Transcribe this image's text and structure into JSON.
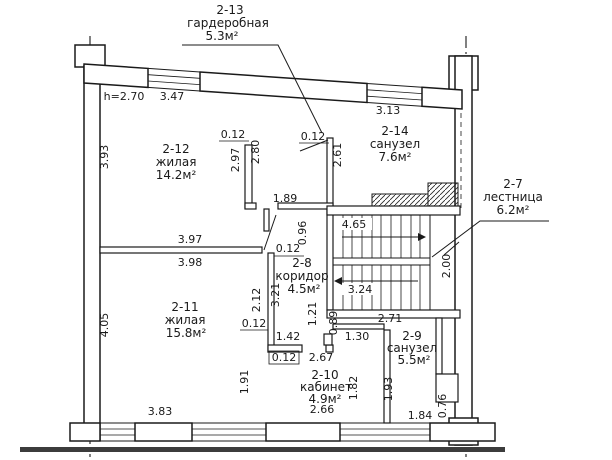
{
  "rooms": {
    "r2_13": {
      "id": "2-13",
      "name": "гардеробная",
      "area": "5.3м²"
    },
    "r2_12": {
      "id": "2-12",
      "name": "жилая",
      "area": "14.2м²"
    },
    "r2_14": {
      "id": "2-14",
      "name": "санузел",
      "area": "7.6м²"
    },
    "r2_7": {
      "id": "2-7",
      "name": "лестница",
      "area": "6.2м²"
    },
    "r2_8": {
      "id": "2-8",
      "name": "коридор",
      "area": "4.5м²"
    },
    "r2_11": {
      "id": "2-11",
      "name": "жилая",
      "area": "15.8м²"
    },
    "r2_9": {
      "id": "2-9",
      "name": "санузел",
      "area": "5.5м²"
    },
    "r2_10": {
      "id": "2-10",
      "name": "кабинет",
      "area": "4.9м²"
    }
  },
  "dims": {
    "ceiling_height": "h=2.70",
    "w_2_12_top": "3.47",
    "w_2_14_top": "3.13",
    "h_2_12_left": "3.93",
    "h_2_11_left": "4.05",
    "wall_thickness": "0.12",
    "h_closet_outer": "2.97",
    "h_closet_inner": "2.80",
    "w_closet": "1.89",
    "door_opening": "0.96",
    "w_2_11_upper": "3.97",
    "w_2_11_lower": "3.98",
    "h_corridor_upper": "2.12",
    "h_corridor_inner": "3.21",
    "h_2_14_left": "2.61",
    "stair_level_upper": "4.65",
    "stair_level_lower": "3.24",
    "h_stair_landing": "2.00",
    "w_2_9_top": "2.71",
    "h_niche_left": "1.21",
    "h_niche_right": "0.89",
    "w_niche": "1.30",
    "w_corridor_bottom": "1.42",
    "w_2_10_top": "2.67",
    "h_2_10_left": "1.91",
    "h_2_10_right": "1.82",
    "w_2_10_bottom": "2.66",
    "h_2_9_right": "1.93",
    "w_2_9_bottom": "1.84",
    "h_duct": "0.76",
    "w_2_11_bottom": "3.83"
  }
}
